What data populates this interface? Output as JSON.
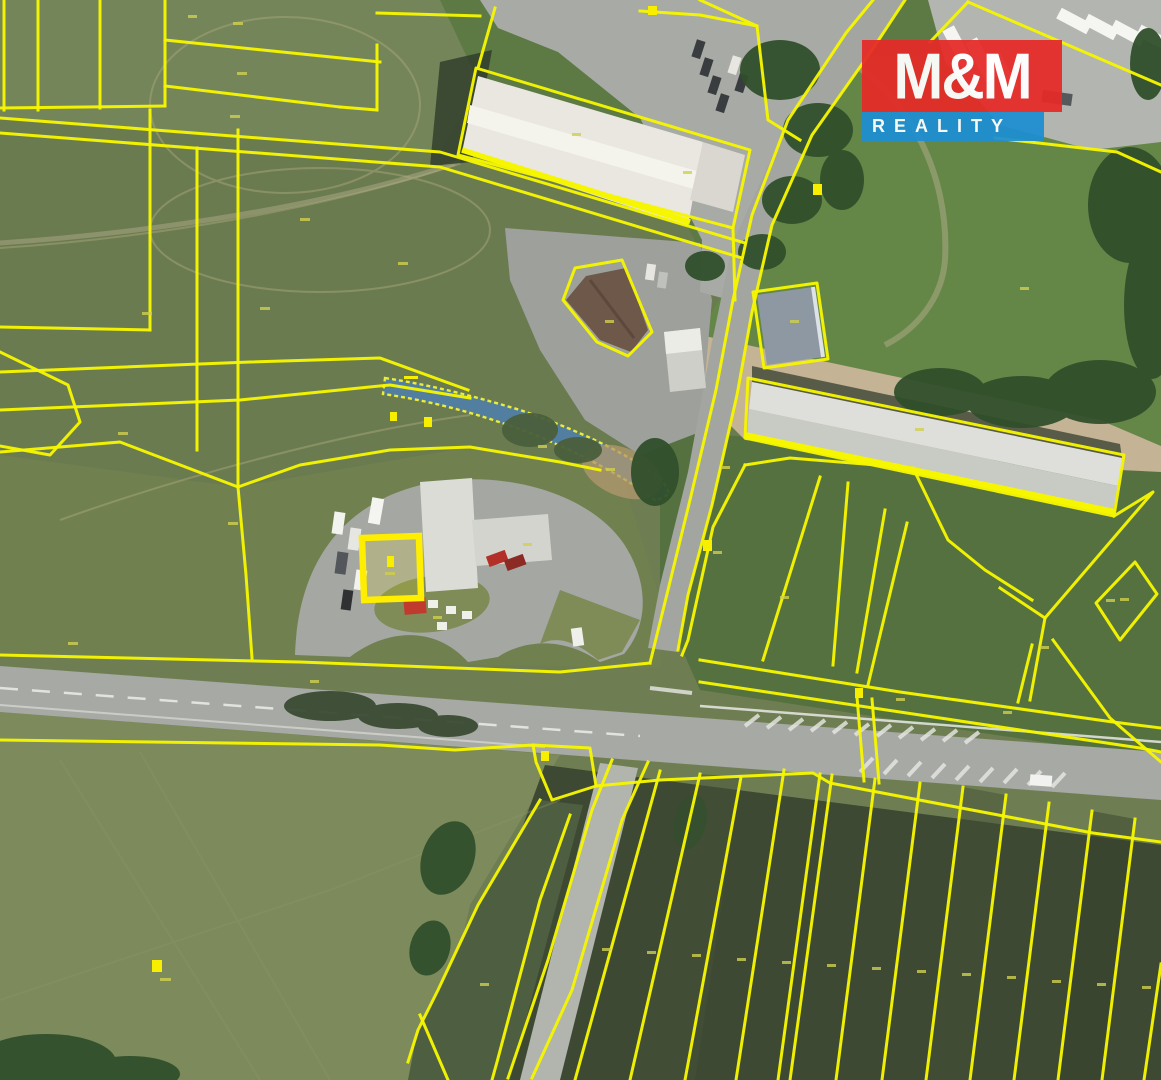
{
  "logo": {
    "title": "M&M",
    "subtitle": "REALITY",
    "title_bg": "#e52b28",
    "subtitle_bg": "#1e8fd2",
    "text_color": "#ffffff"
  },
  "map": {
    "kind": "aerial-cadastral-overlay",
    "overlay_color": "#f6f600",
    "highlight_parcel_color": "#ffee00",
    "stream_color": "#4d7fae",
    "road_color": "#a6a9a4",
    "field_colors": [
      "#6f7e52",
      "#75855a",
      "#7d8a5c",
      "#5d7a44",
      "#55713f",
      "#3e4933"
    ]
  }
}
